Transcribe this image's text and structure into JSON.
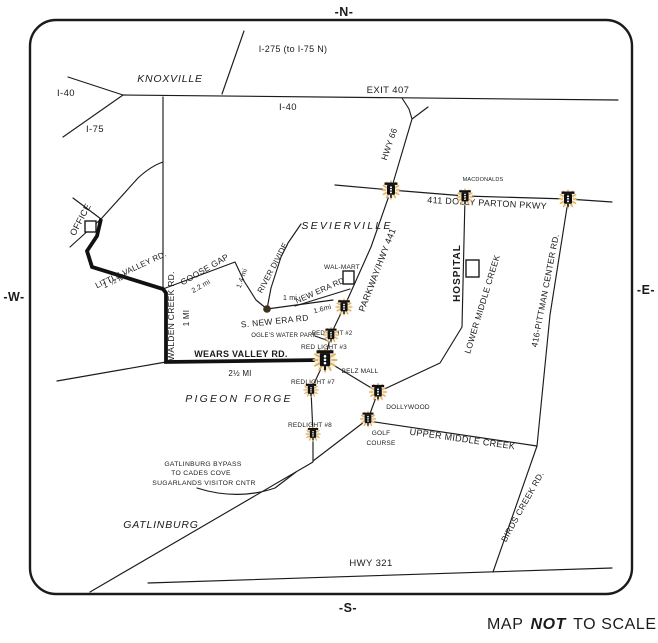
{
  "compass": {
    "north": "-N-",
    "south": "-S-",
    "west": "-W-",
    "east": "-E-"
  },
  "footer": {
    "map": "MAP",
    "not": "NOT",
    "to_scale": "TO SCALE"
  },
  "cities": {
    "knoxville": "KNOXVILLE",
    "sevierville": "SEVIERVILLE",
    "pigeon_forge": "PIGEON FORGE",
    "gatlinburg": "GATLINBURG"
  },
  "highways": {
    "i40_west": "I-40",
    "i40_east": "I-40",
    "i75": "I-75",
    "i275": "I-275 (to I-75 N)",
    "exit_407": "EXIT 407",
    "hwy_66": "HWY 66",
    "hwy_321": "HWY 321"
  },
  "roads": {
    "dolly_parton": "411 DOLLY PARTON PKWY",
    "parkway": "PARKWAY/HWY 441",
    "pittman_center": "416-PITTMAN CENTER RD.",
    "lower_middle_creek": "LOWER MIDDLE CREEK",
    "upper_middle_creek": "UPPER MIDDLE CREEK",
    "birds_creek": "BIRDS CREEK RD.",
    "little_valley": "LITTLE VALLEY RD.",
    "walden_creek": "WALDEN CREEK RD.",
    "goose_gap": "GOOSE GAP",
    "river_divide": "RIVER DIVIDE",
    "s_new_era": "S. NEW ERA RD",
    "new_era": "NEW ERA RD",
    "wears_valley": "WEARS VALLEY RD."
  },
  "distances": {
    "little_valley": "1 ½ MI",
    "walden_creek": "1 MI",
    "goose_gap": "2.2 mi",
    "river_junction": "1.4 mi",
    "s_new_era": "1 mi",
    "new_era": "1.6mi",
    "wears_valley": "2½ MI"
  },
  "landmarks": {
    "office": "OFFICE",
    "walmart": "WAL-MART",
    "hospital": "HOSPITAL",
    "mcdonalds": "MACDONALDS",
    "belz_mall": "BELZ MALL",
    "dollywood": "DOLLYWOOD",
    "ogles_water_park": "OGLE'S WATER PARK",
    "golf_line1": "GOLF",
    "golf_line2": "COURSE"
  },
  "red_lights": {
    "no2": "REDLIGHT #2",
    "no3": "RED LIGHT #3",
    "no7": "REDLIGHT #7",
    "no8": "REDLIGHT #8"
  },
  "notes": {
    "bypass_line1": "GATLINBURG BYPASS",
    "bypass_line2": "TO CADES COVE",
    "bypass_line3": "SUGARLANDS VISITOR CNTR"
  }
}
